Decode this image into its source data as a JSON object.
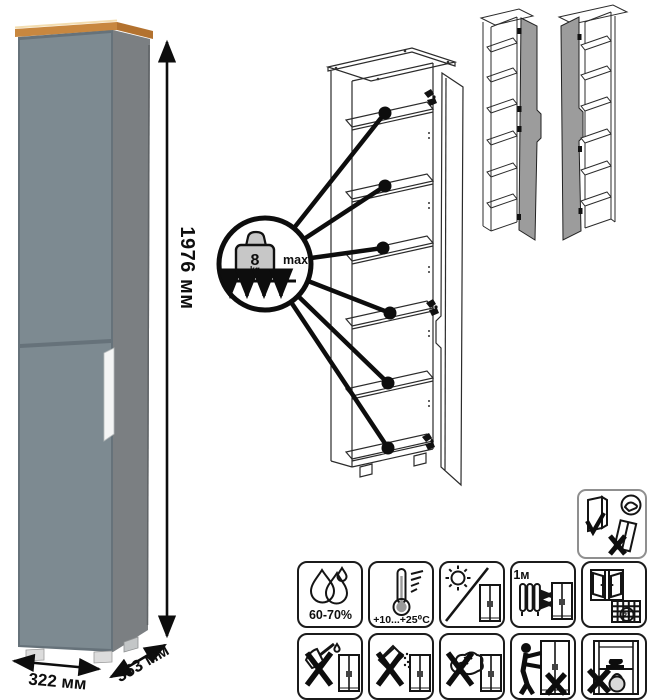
{
  "product": {
    "height_label": "1976 мм",
    "width_label": "322 мм",
    "depth_label": "353 мм"
  },
  "load_callout": {
    "weight_value": "8",
    "weight_unit": "kg",
    "max_label": "max"
  },
  "care": {
    "humidity_label": "60-70%",
    "temperature_label": "+10...+25⁰C",
    "distance_label": "≥1м",
    "calendar_day": "21"
  },
  "icon_names": [
    "humidity-drops-icon",
    "temperature-range-icon",
    "no-direct-sunlight-icon",
    "heat-source-distance-icon",
    "ventilation-calendar-icon",
    "no-sharp-tools-icon",
    "no-abrasive-cleaners-icon",
    "no-wet-wipe-icon",
    "do-not-push-icon",
    "do-not-overload-icon",
    "keep-upright-icon"
  ],
  "colors": {
    "front": "#7d8a91",
    "side": "#7b7f82",
    "wood": "#c8873f",
    "handle": "#f4f5f5",
    "variant_door": "#9c9c9c",
    "line": "#1a1a1a"
  }
}
